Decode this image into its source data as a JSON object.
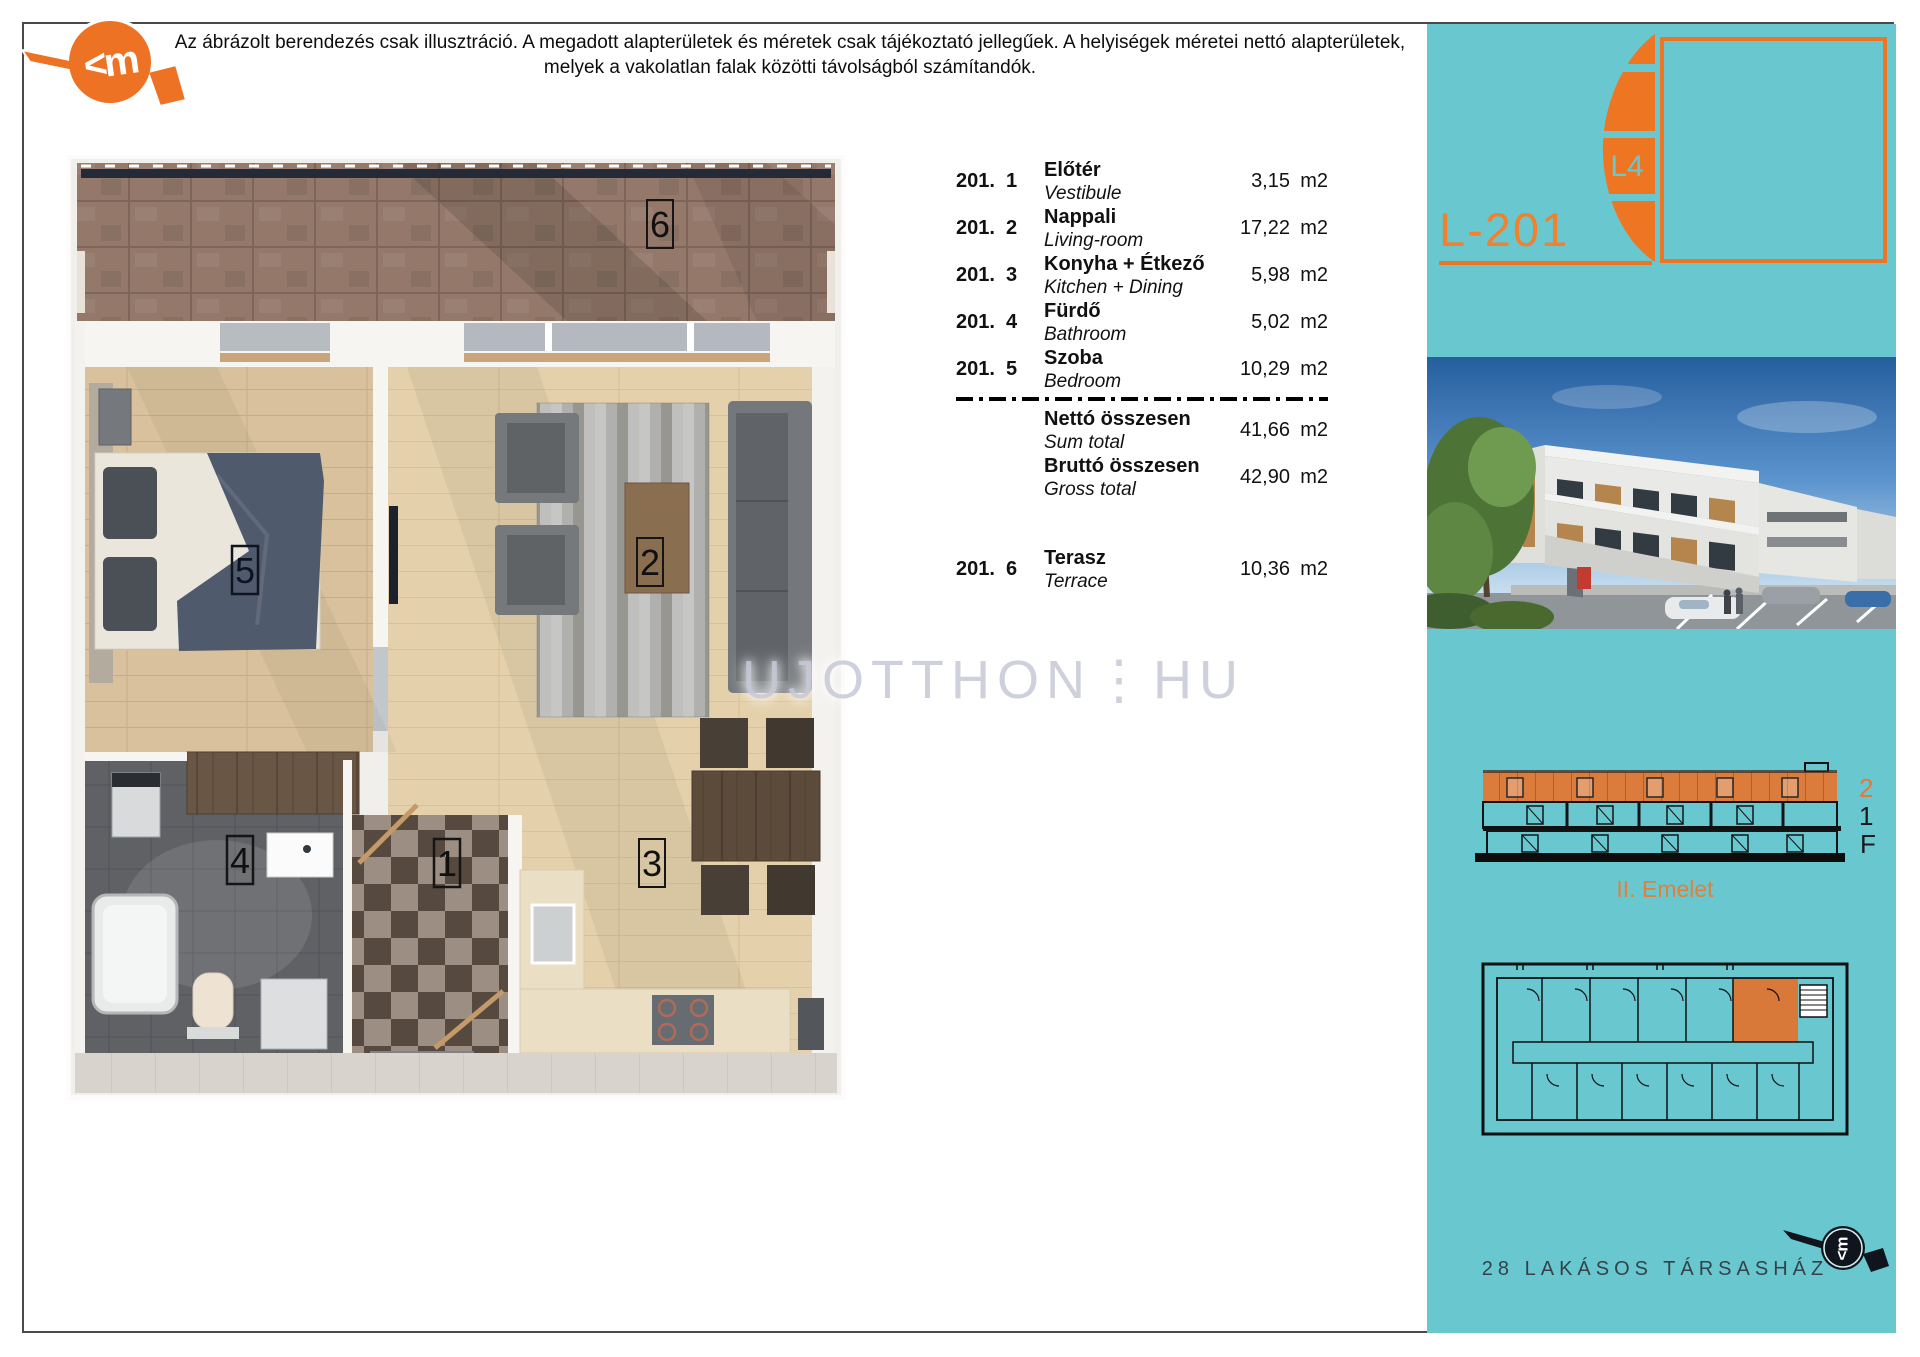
{
  "disclaimer": {
    "line1": "Az ábrázolt berendezés csak illusztráció. A megadott alapterületek és méretek csak tájékoztató jellegűek. A helyiségek méretei nettó alapterületek,",
    "line2": "melyek a vakolatlan falak közötti távolságból számítandók."
  },
  "watermark": "UJOTTHON⋮HU",
  "brand": {
    "mark": "<m"
  },
  "floorplan": {
    "labels": {
      "hall": "1",
      "living": "2",
      "kitchen": "3",
      "bath": "4",
      "bedroom": "5",
      "terrace": "6"
    }
  },
  "table": {
    "rows": [
      {
        "unit": "201.",
        "no": "1",
        "name_hu": "Előtér",
        "name_en": "Vestibule",
        "area": "3,15",
        "sqm": "m2"
      },
      {
        "unit": "201.",
        "no": "2",
        "name_hu": "Nappali",
        "name_en": "Living-room",
        "area": "17,22",
        "sqm": "m2"
      },
      {
        "unit": "201.",
        "no": "3",
        "name_hu": "Konyha + Étkező",
        "name_en": "Kitchen + Dining",
        "area": "5,98",
        "sqm": "m2"
      },
      {
        "unit": "201.",
        "no": "4",
        "name_hu": "Fürdő",
        "name_en": "Bathroom",
        "area": "5,02",
        "sqm": "m2"
      },
      {
        "unit": "201.",
        "no": "5",
        "name_hu": "Szoba",
        "name_en": "Bedroom",
        "area": "10,29",
        "sqm": "m2"
      }
    ],
    "totals": [
      {
        "name_hu": "Nettó összesen",
        "name_en": "Sum total",
        "area": "41,66",
        "sqm": "m2"
      },
      {
        "name_hu": "Bruttó összesen",
        "name_en": "Gross total",
        "area": "42,90",
        "sqm": "m2"
      }
    ],
    "terrace": {
      "unit": "201.",
      "no": "6",
      "name_hu": "Terasz",
      "name_en": "Terrace",
      "area": "10,36",
      "sqm": "m2"
    }
  },
  "sidebar": {
    "unit_code": "L-201",
    "building_code": "L4",
    "section": {
      "floor2": "2",
      "floor1": "1",
      "ground": "F",
      "caption": "II. Emelet"
    },
    "footer": "28 LAKÁSOS TÁRSASHÁZ"
  },
  "colors": {
    "cyan": "#69C8CF",
    "orange": "#EE7623",
    "highlight": "#D87939"
  }
}
